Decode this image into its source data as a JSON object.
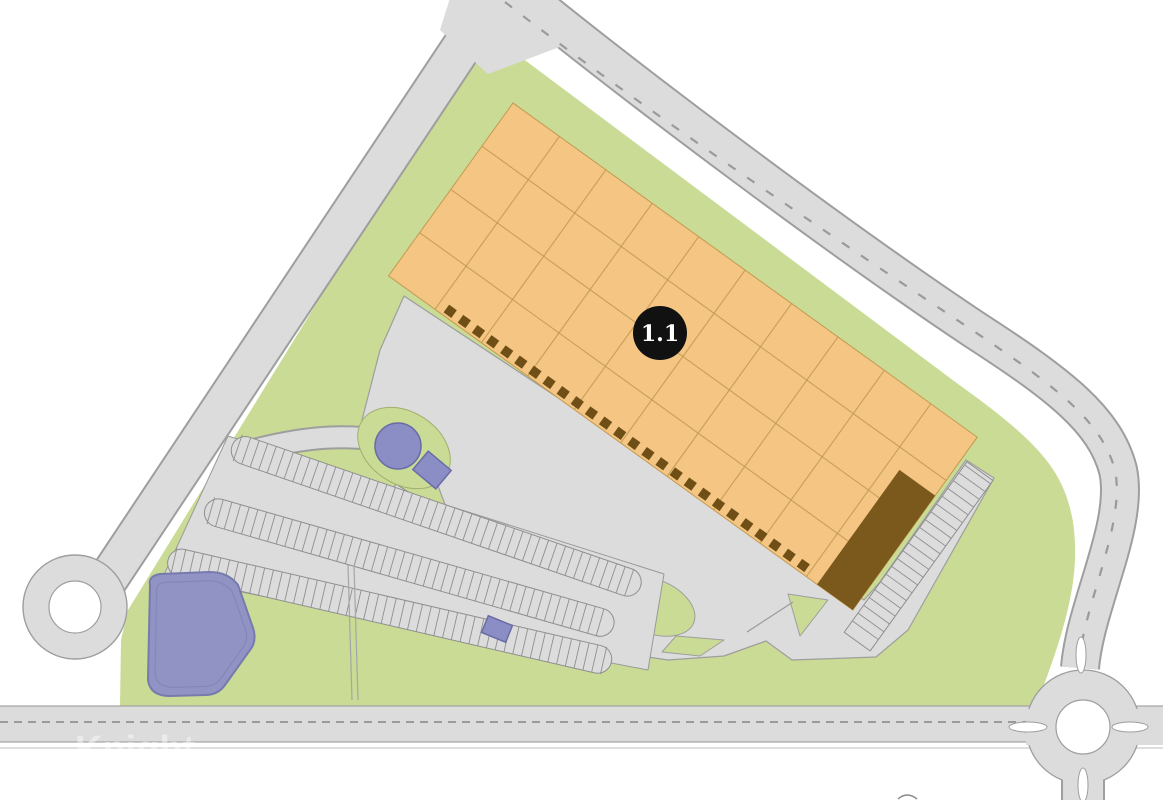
{
  "map": {
    "unit_label": "1.1",
    "watermark": "Knight",
    "colors": {
      "site_green": "#c9db95",
      "road_fill": "#dcdcdc",
      "road_edge": "#9e9e9e",
      "building_fill": "#f4c583",
      "building_grid": "#bf9950",
      "office_fill": "#7b591d",
      "dock_fill": "#6f4f15",
      "water_fill": "#8b8ec4",
      "water_edge": "#696ca6",
      "pond_fill": "#9193c5",
      "pond_edge": "#767aad",
      "badge_bg": "#111111",
      "badge_text": "#ffffff"
    }
  }
}
